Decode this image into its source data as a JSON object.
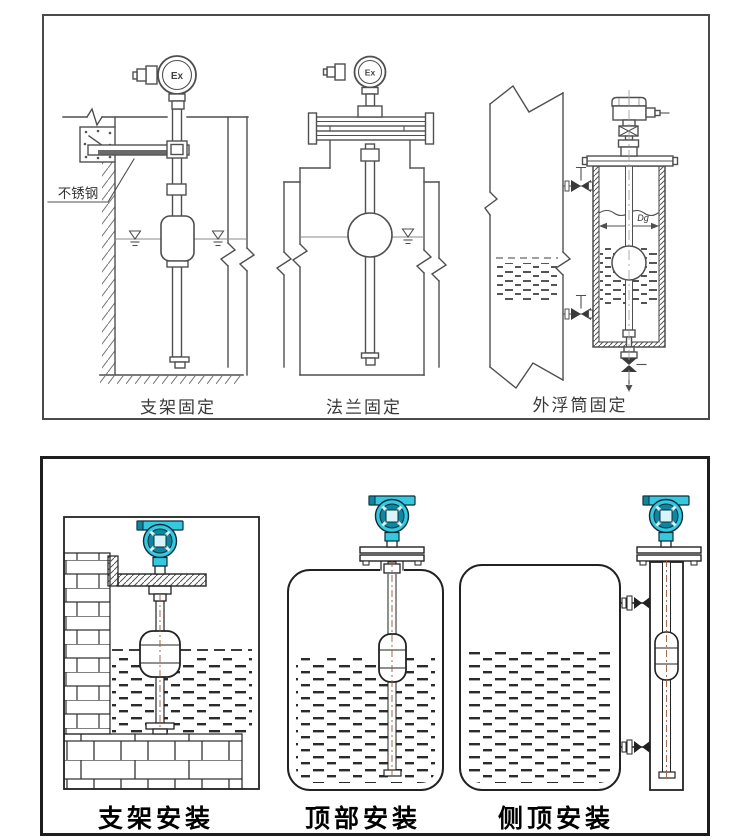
{
  "colors": {
    "line": "#4f4f4f",
    "dark_line": "#1e1e1e",
    "transmitter_body": "#35c8e0",
    "transmitter_dark": "#0e86a0",
    "transmitter_light": "#d9f4f9",
    "valve_fill": "#3a3a3a"
  },
  "top_panel": {
    "figures": [
      {
        "id": "bracket-fixing",
        "caption": "支架固定",
        "head_label": "Ex",
        "material_note": "不锈钢"
      },
      {
        "id": "flange-fixing",
        "caption": "法兰固定",
        "head_label": "Ex"
      },
      {
        "id": "external-chamber-fixing",
        "caption": "外浮筒固定",
        "dimension_label": "Dg"
      }
    ]
  },
  "bottom_panel": {
    "figures": [
      {
        "id": "bracket-install",
        "caption": "支架安装"
      },
      {
        "id": "top-install",
        "caption": "顶部安装"
      },
      {
        "id": "side-top-install",
        "caption": "侧顶安装"
      }
    ]
  }
}
